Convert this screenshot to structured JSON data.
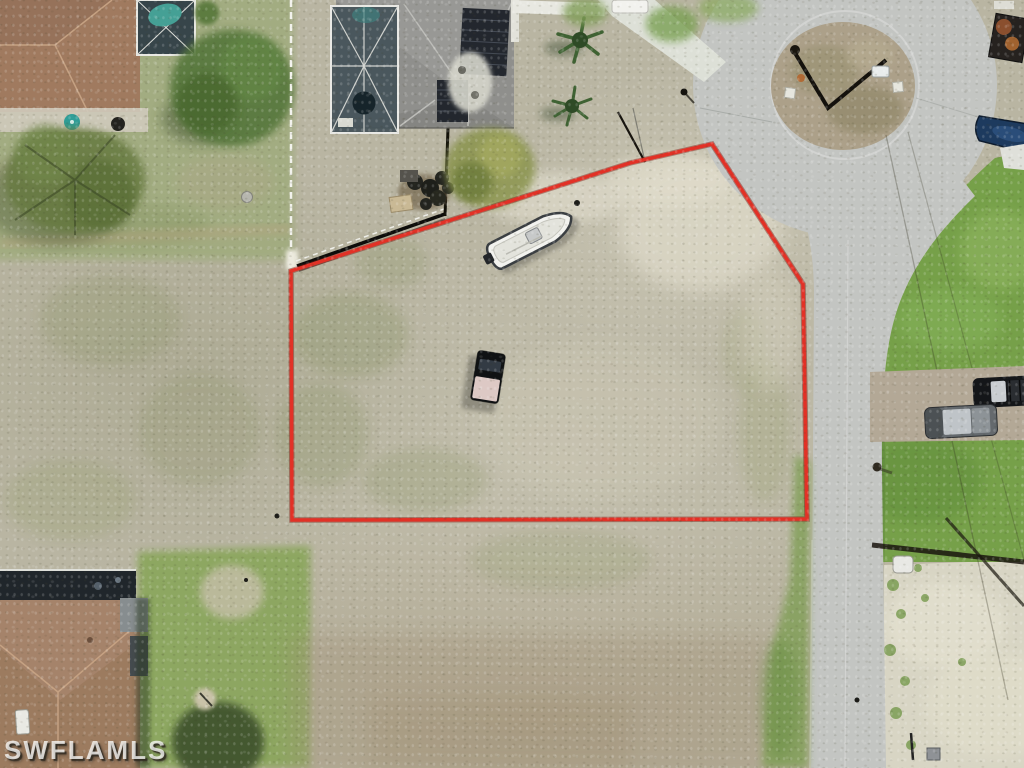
{
  "watermark": {
    "text": "SWFLAMLS"
  },
  "scene": {
    "description": "Aerial drone photo of a vacant residential corner lot outlined in red at the end of a cul-de-sac",
    "boundary_color": "#e23126",
    "colors": {
      "grass": "#76a049",
      "sand": "#b9b5a2",
      "road_concrete": "#c3c5c2",
      "island_dirt": "#aca089",
      "roof_brown": "#9c7b5f",
      "roof_gray": "#8f8f8c"
    },
    "objects": {
      "property_boundary": "red outline around vacant lot",
      "white_boat": "white center-console boat parked inside lot",
      "pickup_truck": "dark pickup truck with light bed cover inside lot",
      "cul_de_sac": "concrete cul-de-sac with sandy center island and utility pole shadow",
      "street": "concrete street running down the east side",
      "black_suv": "black SUV parked on gravel drive at right",
      "gray_suv": "gray SUV parked on gravel drive at right",
      "house_top_left": "brown shingle-roof home with screened pool enclosure",
      "house_top_center": "gray-roof home with rooftop solar panels and pool cage",
      "house_bottom_left": "brown shingle-roof home with skylight",
      "blue_boat_on_trailer": "blue boat on trailer at right edge",
      "trees": "large green trees and palms on neighboring lawns"
    }
  }
}
